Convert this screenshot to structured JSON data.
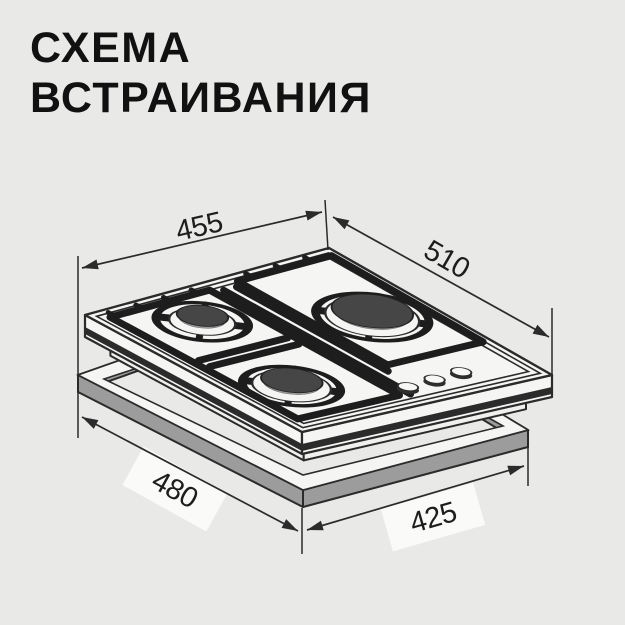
{
  "title": {
    "line1": "СХЕМА",
    "line2": "ВСТРАИВАНИЯ"
  },
  "diagram": {
    "type": "isometric-installation-diagram",
    "appliance": "gas-hob",
    "burner_count": 3,
    "knob_count": 3,
    "dimensions": {
      "hob_width": "455",
      "hob_depth": "510",
      "cutout_width": "480",
      "cutout_depth": "425"
    }
  },
  "colors": {
    "background": "#e9e9e7",
    "line": "#2b2b2b",
    "grate": "#1d1d1d",
    "surface": "#f5f5f4",
    "frame_side": "#9c9c9c",
    "burner_cap": "#464646",
    "burner_body": "#9a9a9a",
    "knob_top": "#f7f7f6",
    "label_text": "#1d1d1d"
  }
}
